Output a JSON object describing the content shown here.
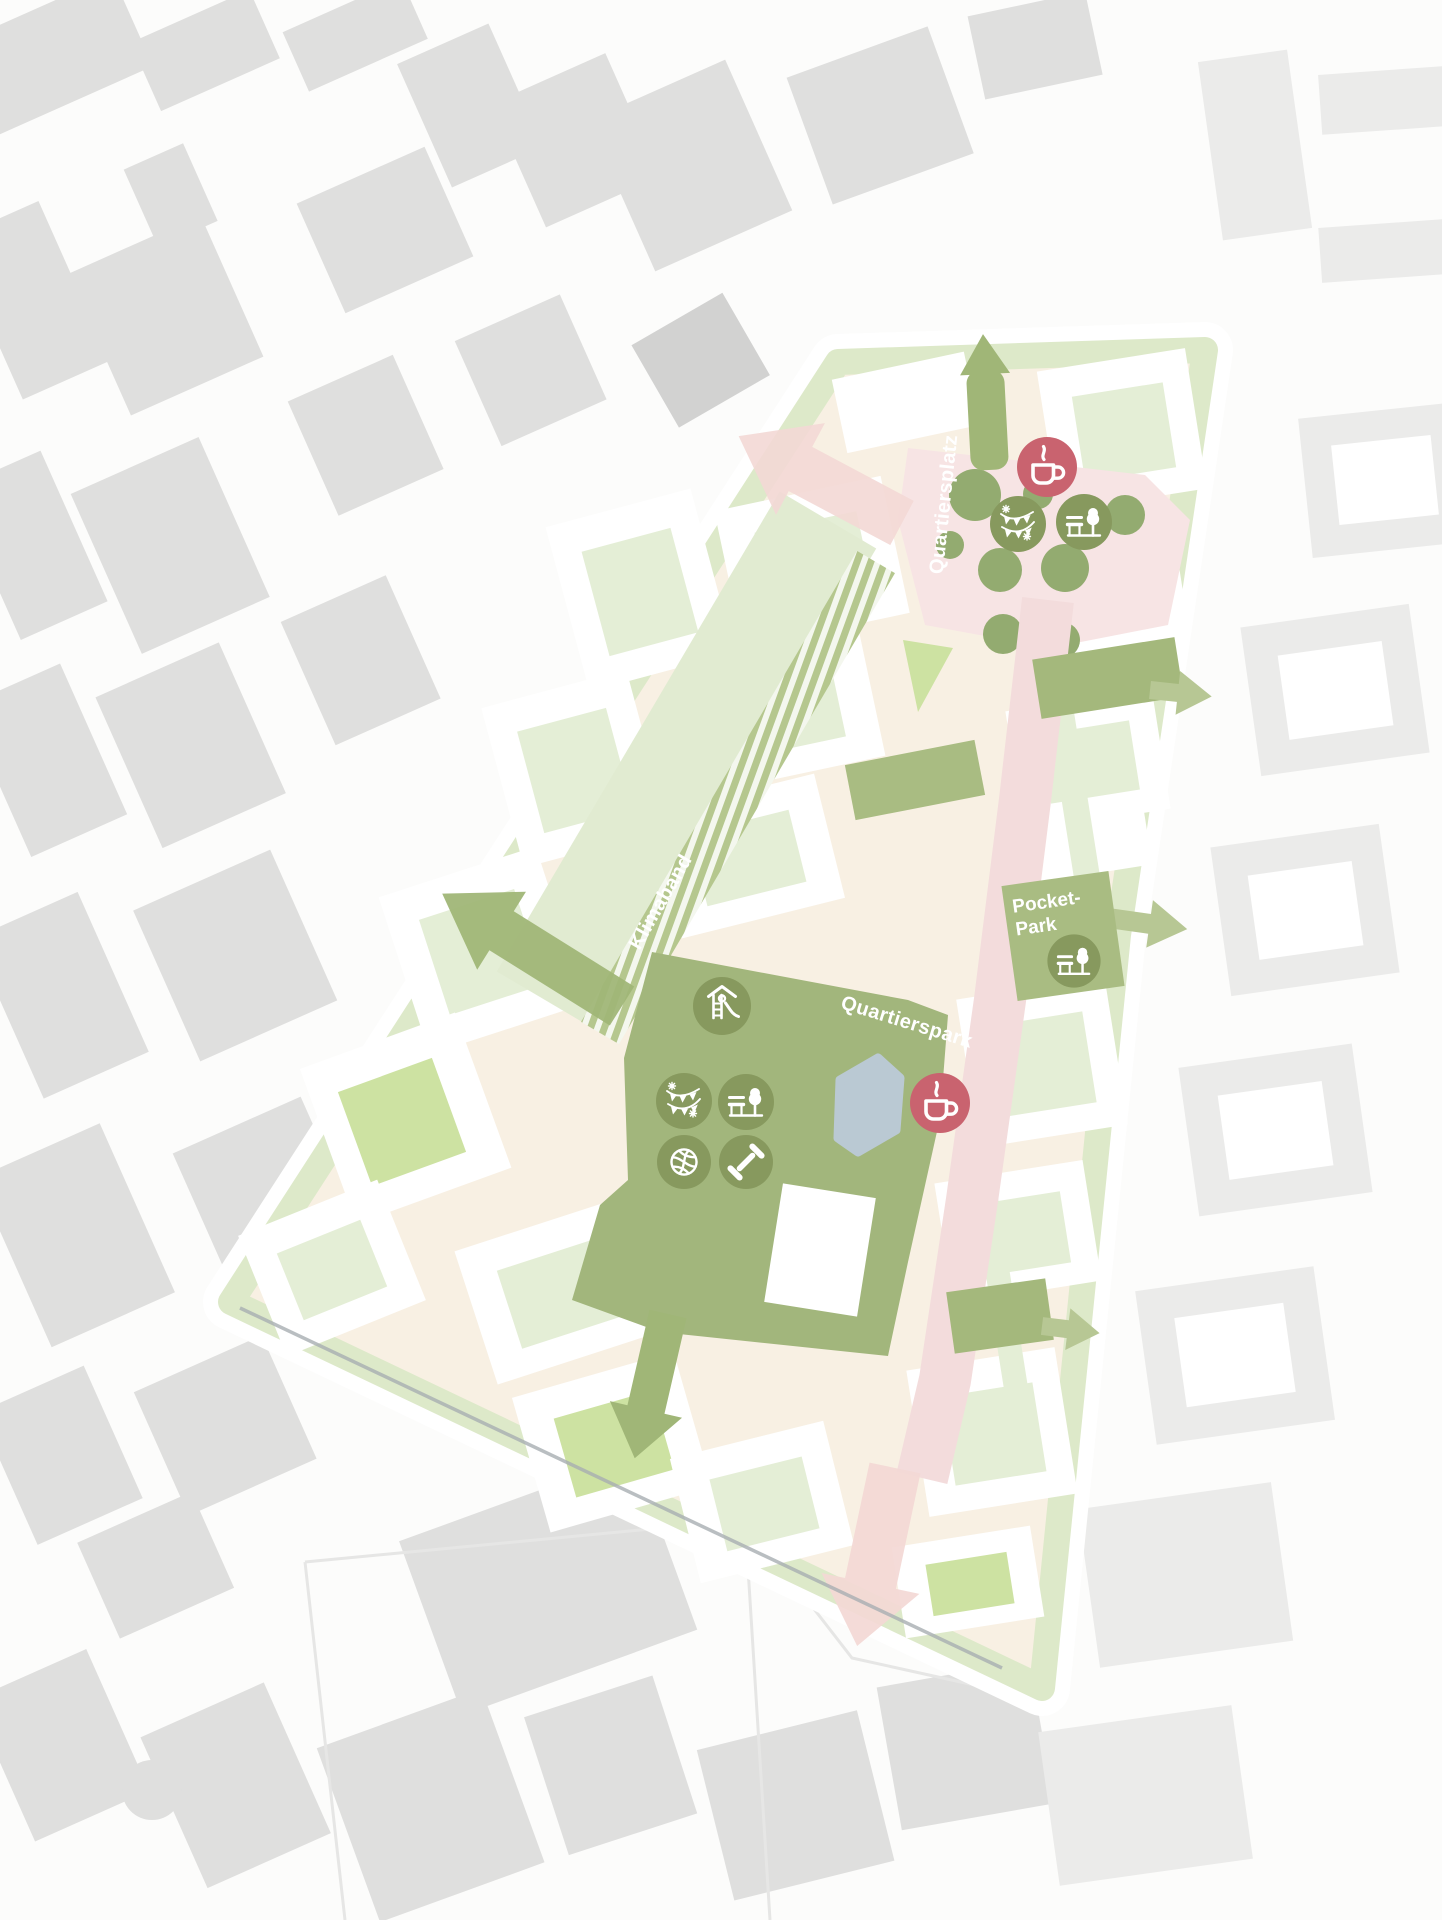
{
  "map": {
    "kind": "urban-masterplan-site-plan",
    "labels": {
      "quartiersplatz": "Quartiersplatz",
      "klimaband": "Klimaband",
      "pocket_park_line1": "Pocket-",
      "pocket_park_line2": "Park",
      "quartierspark": "Quartierspark"
    },
    "icons": [
      {
        "name": "coffee-cup-icon",
        "area": "Quartiersplatz"
      },
      {
        "name": "party-flags-icon",
        "area": "Quartiersplatz"
      },
      {
        "name": "bench-tree-icon",
        "area": "Quartiersplatz"
      },
      {
        "name": "bench-tree-icon",
        "area": "Pocket-Park"
      },
      {
        "name": "playground-icon",
        "area": "Quartierspark"
      },
      {
        "name": "party-flags-icon",
        "area": "Quartierspark"
      },
      {
        "name": "bench-tree-icon",
        "area": "Quartierspark"
      },
      {
        "name": "basketball-icon",
        "area": "Quartierspark"
      },
      {
        "name": "dumbbell-icon",
        "area": "Quartierspark"
      },
      {
        "name": "coffee-cup-icon",
        "area": "Quartierspark"
      }
    ],
    "colors": {
      "background": "#fcfcfb",
      "ctx": "#dfdfde",
      "ctx_light": "#ebebea",
      "ctx_dark": "#d2d2d1",
      "street": "#f8f0e3",
      "ring": "#dde9c9",
      "block_light": "#e4eed6",
      "block_bright": "#cde2a2",
      "block_medium": "#a9bc82",
      "park": "#a2b67c",
      "icon_green": "#87995e",
      "coffee_red": "#c9636f",
      "plaza_pink": "#f7e4e4",
      "promenade_pink": "#f3dcdc",
      "arrow_pink": "#f3d8d5",
      "arrow_green": "#b7c794",
      "arrow_green_dark": "#a4b87c",
      "arrow_green_main": "#a0b677",
      "hatch_green": "#b5c78e",
      "corridor_green": "#e1ebd1",
      "pond": "#bac9d3",
      "tree_olive": "#93ab70",
      "label": "#ffffff",
      "edge_line": "#a8aeb2"
    }
  }
}
